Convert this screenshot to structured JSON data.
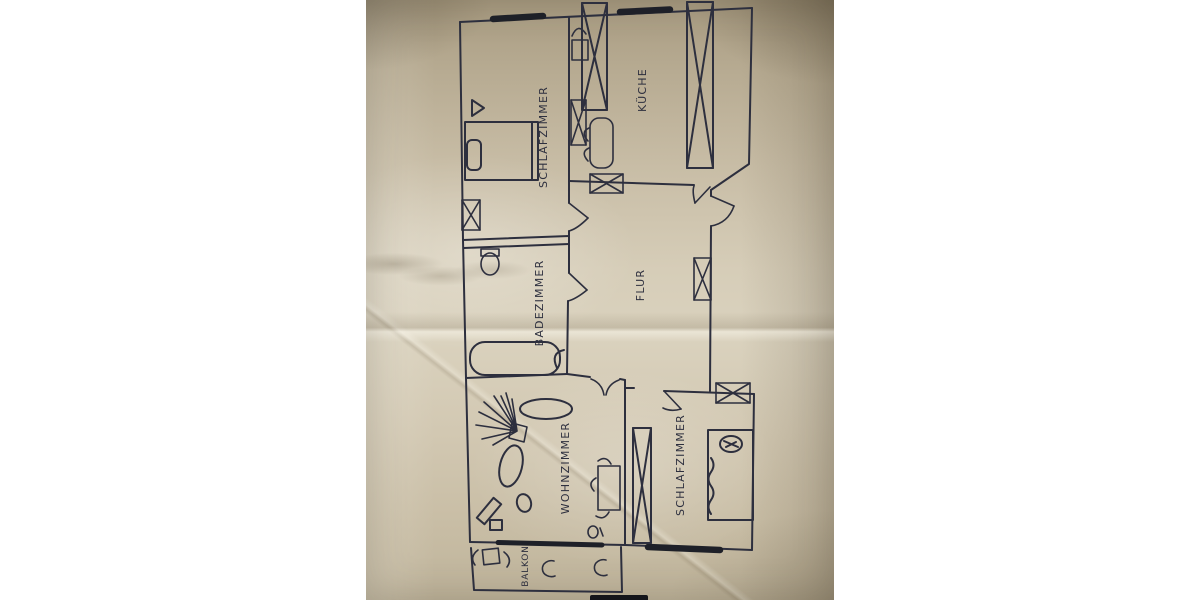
{
  "photo": {
    "description": "Hand-drawn apartment floor plan sketch in dark ink on crumpled beige paper, photographed rotated 90 degrees",
    "paper_color": "#cfc5ae",
    "ink_color": "#2d2f3e",
    "window_bar_color": "#1e2028",
    "background_color": "#ffffff"
  },
  "rooms": [
    {
      "id": "schlafzimmer-1",
      "label": "SCHLAFZIMMER"
    },
    {
      "id": "kueche",
      "label": "KÜCHE"
    },
    {
      "id": "badezimmer",
      "label": "BADEZIMMER"
    },
    {
      "id": "flur",
      "label": "FLUR"
    },
    {
      "id": "wohnzimmer",
      "label": "WOHNZIMMER"
    },
    {
      "id": "schlafzimmer-2",
      "label": "SCHLAFZIMMER"
    },
    {
      "id": "balkon",
      "label": "BALKON"
    }
  ]
}
